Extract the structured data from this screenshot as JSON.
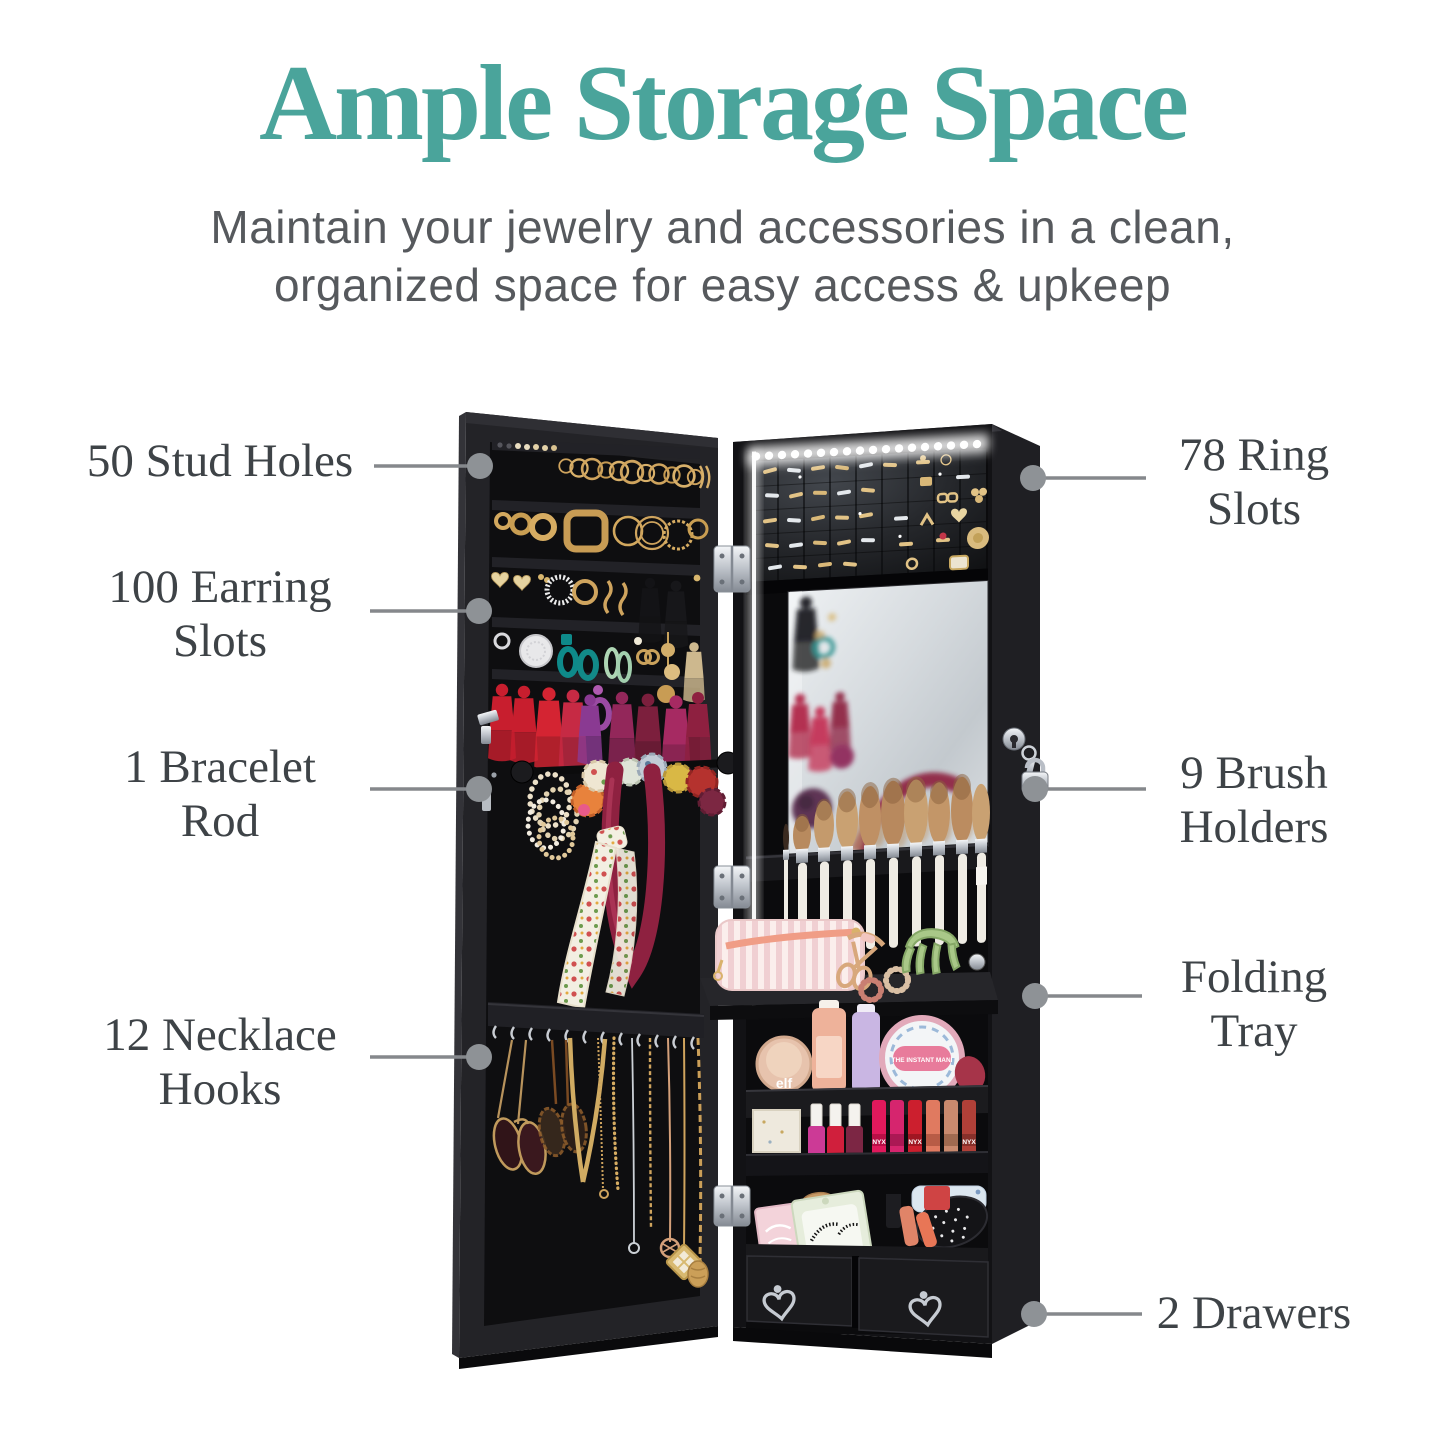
{
  "header": {
    "title": "Ample Storage Space",
    "subtitle_line1": "Maintain your jewelry and accessories in a clean,",
    "subtitle_line2": "organized space for easy access & upkeep"
  },
  "callouts": {
    "stud_holes": {
      "line1": "50 Stud Holes",
      "line2": ""
    },
    "earring_slots": {
      "line1": "100 Earring",
      "line2": "Slots"
    },
    "bracelet_rod": {
      "line1": "1 Bracelet",
      "line2": "Rod"
    },
    "necklace_hooks": {
      "line1": "12 Necklace",
      "line2": "Hooks"
    },
    "ring_slots": {
      "line1": "78 Ring",
      "line2": "Slots"
    },
    "brush_holders": {
      "line1": "9 Brush",
      "line2": "Holders"
    },
    "folding_tray": {
      "line1": "Folding",
      "line2": "Tray"
    },
    "drawers": {
      "line1": "2 Drawers",
      "line2": ""
    }
  },
  "product_labels": {
    "blush_compact": "elf",
    "mani_tin": "THE INSTANT MANI",
    "lipstick_brand": "NYX"
  },
  "colors": {
    "accent_teal": "#4AA49B",
    "label_gray": "#3E4347",
    "subtitle_gray": "#56595D",
    "leader_gray": "#8E9296",
    "cabinet_black": "#141416",
    "led_white": "#FFFFFF"
  }
}
